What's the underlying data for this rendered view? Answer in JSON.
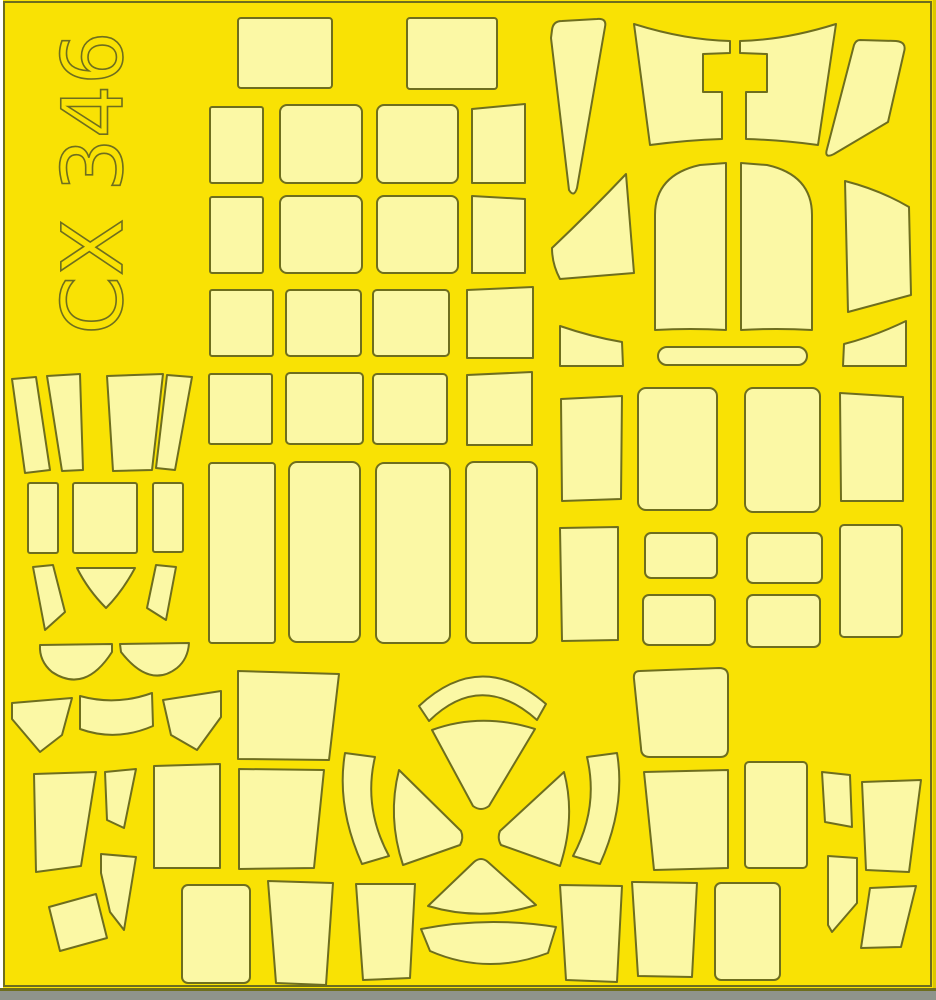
{
  "sheet": {
    "code": "CX 346",
    "description": "die-cut paint mask sheet"
  },
  "colors": {
    "bg_yellow": "#F9E204",
    "mask_fill": "#FBF8A5",
    "outline": "#6E6E1E",
    "bottom_strip": "#8F948C",
    "edge_white": "#FFFFFF",
    "edge_dark_yellow": "#DCC800"
  },
  "shapes": [
    {
      "name": "mask-top-rect-1",
      "rect": {
        "x": 238,
        "y": 18,
        "w": 94,
        "h": 70,
        "rx": 3
      }
    },
    {
      "name": "mask-top-rect-2",
      "rect": {
        "x": 407,
        "y": 18,
        "w": 90,
        "h": 71,
        "rx": 3
      }
    },
    {
      "name": "mask-grid-a1",
      "rect": {
        "x": 210,
        "y": 107,
        "w": 53,
        "h": 76,
        "rx": 2
      }
    },
    {
      "name": "mask-grid-a2",
      "rect": {
        "x": 280,
        "y": 105,
        "w": 82,
        "h": 78,
        "rx": 7
      }
    },
    {
      "name": "mask-grid-a3",
      "rect": {
        "x": 377,
        "y": 105,
        "w": 81,
        "h": 78,
        "rx": 7
      }
    },
    {
      "name": "mask-grid-a4",
      "points": "472,109 525,104 525,183 472,183"
    },
    {
      "name": "mask-grid-b1",
      "rect": {
        "x": 210,
        "y": 197,
        "w": 53,
        "h": 76,
        "rx": 2
      }
    },
    {
      "name": "mask-grid-b2",
      "rect": {
        "x": 280,
        "y": 196,
        "w": 82,
        "h": 77,
        "rx": 7
      }
    },
    {
      "name": "mask-grid-b3",
      "rect": {
        "x": 377,
        "y": 196,
        "w": 81,
        "h": 77,
        "rx": 7
      }
    },
    {
      "name": "mask-grid-b4",
      "points": "472,196 525,199 525,273 472,273"
    },
    {
      "name": "mask-grid-c1",
      "rect": {
        "x": 210,
        "y": 290,
        "w": 63,
        "h": 66,
        "rx": 2
      }
    },
    {
      "name": "mask-grid-c2",
      "rect": {
        "x": 286,
        "y": 290,
        "w": 75,
        "h": 66,
        "rx": 4
      }
    },
    {
      "name": "mask-grid-c3",
      "rect": {
        "x": 373,
        "y": 290,
        "w": 76,
        "h": 66,
        "rx": 4
      }
    },
    {
      "name": "mask-grid-c4",
      "points": "467,290 533,287 533,358 467,358"
    },
    {
      "name": "mask-grid-d1",
      "rect": {
        "x": 209,
        "y": 374,
        "w": 63,
        "h": 70,
        "rx": 2
      }
    },
    {
      "name": "mask-grid-d2",
      "rect": {
        "x": 286,
        "y": 373,
        "w": 77,
        "h": 71,
        "rx": 4
      }
    },
    {
      "name": "mask-grid-d3",
      "rect": {
        "x": 373,
        "y": 374,
        "w": 74,
        "h": 70,
        "rx": 4
      }
    },
    {
      "name": "mask-grid-d4",
      "points": "467,375 532,372 532,445 467,445"
    },
    {
      "name": "mask-column-e1",
      "rect": {
        "x": 209,
        "y": 463,
        "w": 66,
        "h": 180,
        "rx": 3
      }
    },
    {
      "name": "mask-column-e2",
      "rect": {
        "x": 289,
        "y": 462,
        "w": 71,
        "h": 180,
        "rx": 8
      }
    },
    {
      "name": "mask-column-e3",
      "rect": {
        "x": 376,
        "y": 463,
        "w": 74,
        "h": 180,
        "rx": 8
      }
    },
    {
      "name": "mask-column-e4",
      "rect": {
        "x": 466,
        "y": 462,
        "w": 71,
        "h": 181,
        "rx": 8
      }
    },
    {
      "name": "mask-canopy-blade-left",
      "d": "M 552 30 Q 553 21 562 21 L 597 19 Q 607 18 605 27 L 577 188 Q 574 198 569 190 L 551 38 Z"
    },
    {
      "name": "mask-windshield-left",
      "d": "M 634 24 Q 685 40 730 41 L 730 53 L 703 54 L 703 92 L 722 92 L 722 139 Q 688 140 650 145 Z"
    },
    {
      "name": "mask-windshield-right",
      "d": "M 836 24 Q 785 40 740 41 L 740 53 L 767 54 L 767 92 L 746 92 L 746 139 Q 782 140 818 145 Z"
    },
    {
      "name": "mask-canopy-blade-right",
      "d": "M 860 40 L 896 41 Q 907 42 904 52 L 888 122 L 834 154 Q 824 159 827 149 L 854 45 Q 856 40 860 40 Z"
    },
    {
      "name": "mask-canopy-wedge-left",
      "d": "M 626 174 L 634 273 L 560 279 Q 552 264 552 248 Q 590 212 626 174 Z"
    },
    {
      "name": "mask-canopy-arch-left",
      "d": "M 655 330 L 655 215 Q 655 175 700 165 L 726 163 L 726 330 Q 690 328 655 330 Z"
    },
    {
      "name": "mask-canopy-arch-right",
      "d": "M 812 330 L 812 215 Q 812 175 767 165 L 741 163 L 741 330 Q 777 328 812 330 Z"
    },
    {
      "name": "mask-canopy-wedge-right",
      "d": "M 845 181 Q 880 190 909 207 L 911 295 L 848 312 Z"
    },
    {
      "name": "mask-corner-wedge-left",
      "d": "M 560 326 Q 592 337 622 342 L 623 366 L 560 366 Z"
    },
    {
      "name": "mask-corner-wedge-right",
      "d": "M 906 321 Q 875 336 844 344 L 843 366 L 906 366 Z"
    },
    {
      "name": "mask-capsule-strip",
      "rect": {
        "x": 658,
        "y": 347,
        "w": 149,
        "h": 18,
        "rx": 9
      }
    },
    {
      "name": "mask-right-f1",
      "points": "561,399 622,396 621,499 562,501"
    },
    {
      "name": "mask-right-f2",
      "rect": {
        "x": 638,
        "y": 388,
        "w": 79,
        "h": 122,
        "rx": 8
      }
    },
    {
      "name": "mask-right-f3",
      "rect": {
        "x": 745,
        "y": 388,
        "w": 75,
        "h": 124,
        "rx": 8
      }
    },
    {
      "name": "mask-right-f4",
      "points": "840,393 903,397 903,501 841,501"
    },
    {
      "name": "mask-right-g1",
      "points": "560,528 618,527 618,640 562,641"
    },
    {
      "name": "mask-right-g2",
      "rect": {
        "x": 645,
        "y": 533,
        "w": 72,
        "h": 45,
        "rx": 6
      }
    },
    {
      "name": "mask-right-g3",
      "rect": {
        "x": 747,
        "y": 533,
        "w": 75,
        "h": 50,
        "rx": 6
      }
    },
    {
      "name": "mask-right-g4",
      "rect": {
        "x": 840,
        "y": 525,
        "w": 62,
        "h": 112,
        "rx": 4
      }
    },
    {
      "name": "mask-right-g5",
      "rect": {
        "x": 643,
        "y": 595,
        "w": 72,
        "h": 50,
        "rx": 6
      }
    },
    {
      "name": "mask-right-g6",
      "rect": {
        "x": 747,
        "y": 595,
        "w": 73,
        "h": 52,
        "rx": 6
      }
    },
    {
      "name": "mask-fan-left-s1",
      "points": "12,379 36,377 50,470 25,473"
    },
    {
      "name": "mask-fan-left-s2",
      "points": "47,376 80,374 83,470 62,471"
    },
    {
      "name": "mask-fan-left-s3",
      "points": "107,376 163,374 152,470 113,471"
    },
    {
      "name": "mask-fan-left-s4",
      "points": "167,375 192,377 175,470 156,468"
    },
    {
      "name": "mask-left-rect-1",
      "rect": {
        "x": 28,
        "y": 483,
        "w": 30,
        "h": 70,
        "rx": 2
      }
    },
    {
      "name": "mask-left-square",
      "rect": {
        "x": 73,
        "y": 483,
        "w": 64,
        "h": 70,
        "rx": 2
      }
    },
    {
      "name": "mask-left-rect-2",
      "rect": {
        "x": 153,
        "y": 483,
        "w": 30,
        "h": 69,
        "rx": 2
      }
    },
    {
      "name": "mask-left-sliver-1",
      "points": "33,567 53,565 65,612 45,630"
    },
    {
      "name": "mask-left-triangle",
      "d": "M 77 568 L 135 568 Q 122 592 106 608 Q 88 590 77 568 Z"
    },
    {
      "name": "mask-left-sliver-2",
      "points": "176,567 156,565 147,608 166,620"
    },
    {
      "name": "mask-halfdisc-left",
      "d": "M 40 645 L 112 644 L 112 652 Q 85 694 52 672 Q 39 661 40 645 Z"
    },
    {
      "name": "mask-halfdisc-right",
      "d": "M 120 644 L 189 643 Q 188 659 177 668 Q 150 689 121 652 Z"
    },
    {
      "name": "mask-bl-kite-left",
      "points": "12,703 72,698 62,735 40,752 12,719"
    },
    {
      "name": "mask-bl-curved-band",
      "d": "M 80 696 Q 116 706 152 693 L 153 726 Q 116 742 80 729 Z"
    },
    {
      "name": "mask-bl-kite-right",
      "points": "163,700 221,691 221,717 197,750 171,735"
    },
    {
      "name": "mask-bl-trapezoid",
      "points": "34,774 96,772 81,866 36,872"
    },
    {
      "name": "mask-bl-quad",
      "points": "105,772 136,769 124,828 107,820"
    },
    {
      "name": "mask-bl-tall-rect",
      "points": "154,766 220,764 220,868 154,868"
    },
    {
      "name": "mask-bl-blade",
      "points": "101,854 136,857 124,930 110,912 101,873"
    },
    {
      "name": "mask-bl-parallelogram",
      "points": "49,907 96,894 107,938 60,951"
    },
    {
      "name": "mask-bl-square",
      "rect": {
        "x": 182,
        "y": 885,
        "w": 68,
        "h": 98,
        "rx": 6
      }
    },
    {
      "name": "mask-bc-trap-1",
      "points": "238,671 339,674 329,760 238,759"
    },
    {
      "name": "mask-bc-trap-2",
      "points": "239,769 324,770 314,868 239,869"
    },
    {
      "name": "mask-fan-top-outer",
      "d": "M 419 706 Q 481 648 546 704 L 537 720 Q 481 670 429 721 Z"
    },
    {
      "name": "mask-fan-top-inner",
      "d": "M 432 730 Q 481 712 535 729 L 489 806 Q 481 812 473 806 Z"
    },
    {
      "name": "mask-fan-west",
      "d": "M 399 770 L 461 831 Q 464 838 460 845 L 403 865 Q 387 817 399 770 Z"
    },
    {
      "name": "mask-fan-east",
      "d": "M 564 772 L 500 831 Q 497 838 501 845 L 560 866 Q 576 817 564 772 Z"
    },
    {
      "name": "mask-fan-bottom-inner",
      "d": "M 474 862 Q 481 856 488 862 L 536 905 Q 482 922 428 906 Z"
    },
    {
      "name": "mask-fan-bottom-outer",
      "d": "M 421 929 Q 487 916 556 927 L 548 953 Q 487 976 430 951 Z"
    },
    {
      "name": "mask-fan-sliver-left",
      "d": "M 345 753 L 375 757 Q 363 808 389 856 L 362 864 Q 336 806 345 753 Z"
    },
    {
      "name": "mask-fan-sliver-right",
      "d": "M 617 753 L 587 757 Q 599 808 573 856 L 600 864 Q 626 806 617 753 Z"
    },
    {
      "name": "mask-bottom-trap-1",
      "points": "268,881 333,883 326,985 276,983"
    },
    {
      "name": "mask-bottom-trap-2",
      "points": "356,884 415,884 410,978 363,980"
    },
    {
      "name": "mask-bottom-trap-3",
      "points": "560,885 622,886 617,982 566,980"
    },
    {
      "name": "mask-br-big-trap",
      "d": "M 640 671 L 719 668 Q 728 668 728 676 L 728 749 Q 728 757 720 757 L 650 757 Q 641 757 641 748 L 634 679 Q 633 671 640 671 Z"
    },
    {
      "name": "mask-br-trap-2",
      "points": "644,772 728,770 728,868 654,870"
    },
    {
      "name": "mask-br-rect",
      "rect": {
        "x": 745,
        "y": 762,
        "w": 62,
        "h": 106,
        "rx": 4
      }
    },
    {
      "name": "mask-br-quad",
      "points": "822,772 850,775 852,827 825,822"
    },
    {
      "name": "mask-br-trap-right",
      "points": "862,782 921,780 909,872 866,870"
    },
    {
      "name": "mask-br-flag",
      "points": "828,856 857,858 857,903 832,932 828,925"
    },
    {
      "name": "mask-br-parallelogram",
      "points": "870,888 916,886 901,947 861,948"
    },
    {
      "name": "mask-br-bottom-trap",
      "points": "632,882 697,883 692,977 638,976"
    },
    {
      "name": "mask-br-bottom-rect",
      "rect": {
        "x": 715,
        "y": 883,
        "w": 65,
        "h": 97,
        "rx": 6
      }
    }
  ]
}
